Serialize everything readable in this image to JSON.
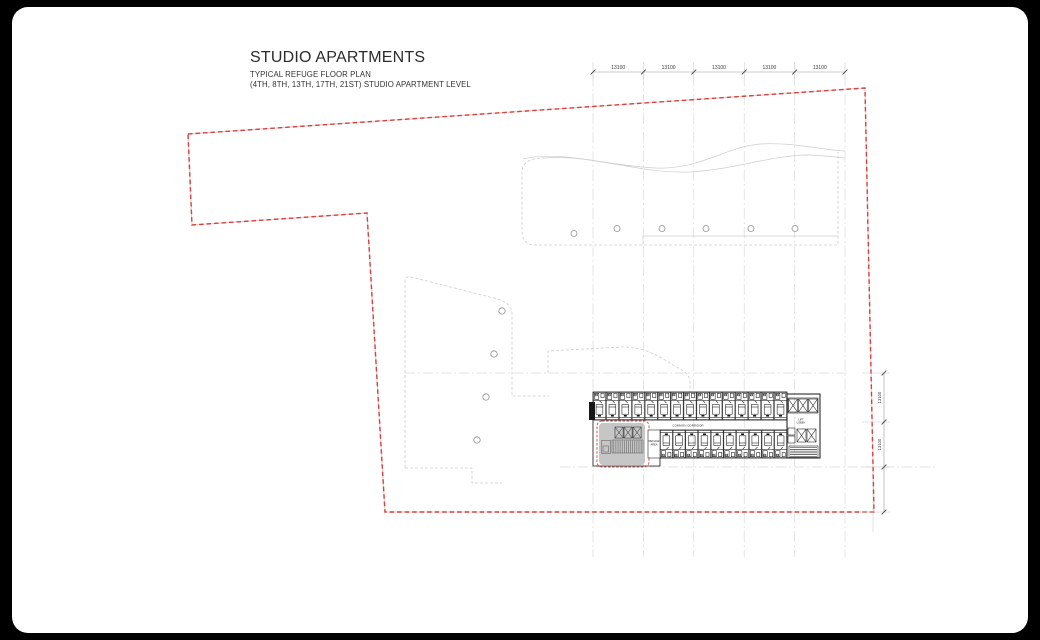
{
  "sheet": {
    "background": "#000000",
    "paper": "#ffffff"
  },
  "title_block": {
    "title": "STUDIO APARTMENTS",
    "subtitle": "TYPICAL REFUGE FLOOR PLAN",
    "level_note": "(4TH, 8TH, 13TH, 17TH, 21ST) STUDIO APARTMENT LEVEL"
  },
  "plan": {
    "colors": {
      "boundary_red": "#cf4444",
      "outline_gray": "#cdcdcd",
      "plan_ink": "#161616",
      "refuge_fill": "#c6c6c6",
      "grid_gray": "#d4d4d4",
      "dim_text": "#3a3a3a"
    },
    "dimensions": {
      "top": [
        "13100",
        "13100",
        "13100",
        "13100",
        "13100"
      ],
      "right": [
        "13100",
        "13100"
      ]
    },
    "labels": {
      "corridor": "COMMON CORRIDOR",
      "lift_lobby_line1": "LIFT",
      "lift_lobby_line2": "LOBBY",
      "refuge_line1": "REFUGE",
      "refuge_line2": "AREA"
    },
    "units": {
      "top_count": 15,
      "bottom_count": 10
    },
    "columns": {
      "upper_count": 6,
      "left_count": 4
    }
  }
}
